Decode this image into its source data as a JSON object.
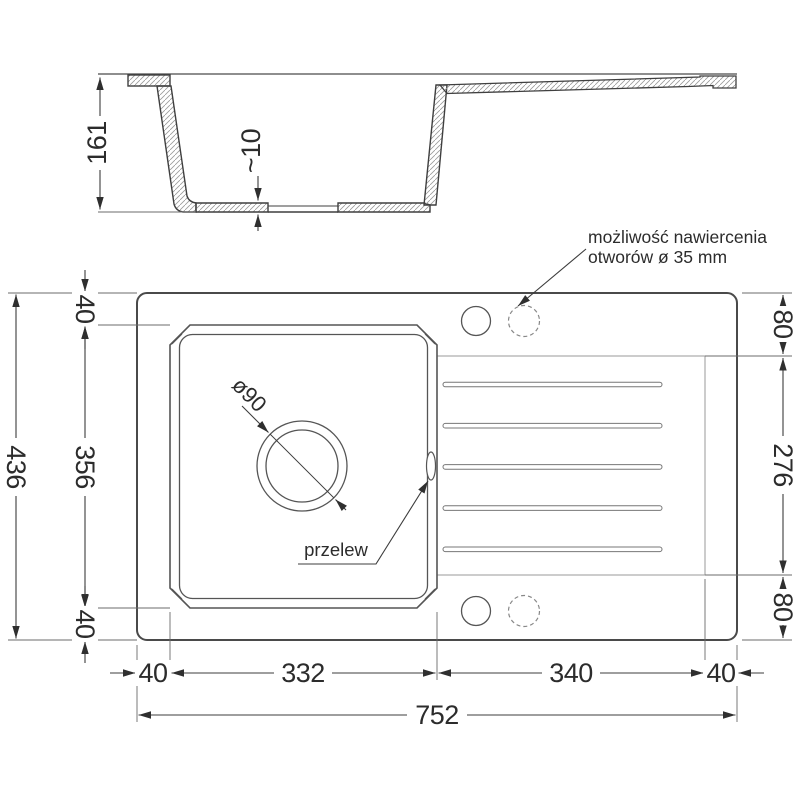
{
  "drawing": {
    "section": {
      "overall_height": "161",
      "floor_thickness": "~10"
    },
    "plan": {
      "left": {
        "total_depth": "436",
        "top_margin": "40",
        "bowl_depth": "356",
        "bottom_margin": "40"
      },
      "right": {
        "top_offset": "80",
        "drainer_depth": "276",
        "bottom_offset": "80"
      },
      "bottom": {
        "left_margin": "40",
        "bowl_width": "332",
        "drainer_width": "340",
        "right_margin": "40",
        "total_width": "752"
      },
      "drain_diameter_label": "ø90",
      "overflow_label": "przelew",
      "note_line1": "możliwość nawiercenia",
      "note_line2": "otworów ø 35 mm"
    },
    "colors": {
      "main_line": "#3f3f3f",
      "thin_line": "#6b6b6b",
      "light_line": "#999999",
      "hatch": "#9a9a9a"
    }
  }
}
